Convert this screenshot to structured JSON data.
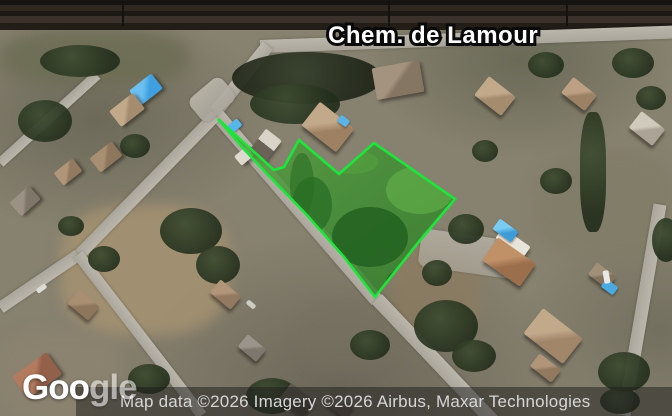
{
  "street_label": "Chem. de Lamour",
  "logo": {
    "text": "Google",
    "bright": "Goo",
    "faded": "gle"
  },
  "attribution": {
    "text": "Map data ©2026 Imagery ©2026 Airbus, Maxar Technologies"
  },
  "parcel": {
    "points": "218,119 274,170 284,167 299,140 339,174 374,143 455,199 417,244 375,297 344,257 305,213 268,175 242,147",
    "outline_color": "#1ee53b",
    "fill_color": "#3f8f2f"
  },
  "colors": {
    "pool_blue": "#45a9e2",
    "road_gray": "#b2aea3",
    "terrain_base": "#87816f",
    "attribution_bg": "rgba(28,28,28,0.5)",
    "label_text": "#ffffff",
    "label_outline": "#0a0a0a"
  }
}
